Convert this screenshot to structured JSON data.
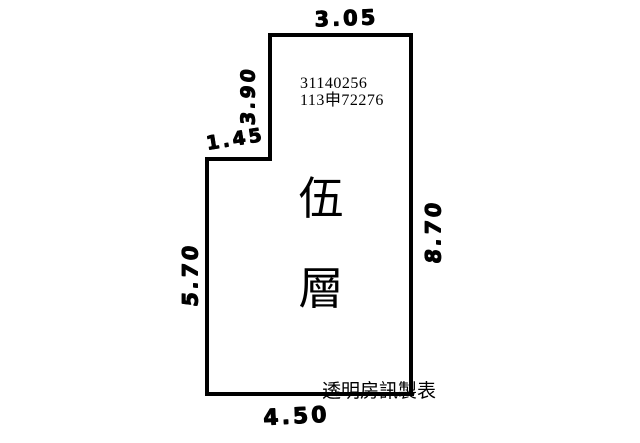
{
  "dimensions": {
    "top": "3.05",
    "upper_left": "3.90",
    "notch": "1.45",
    "left_lower": "5.70",
    "right": "8.70",
    "bottom": "4.50"
  },
  "labels": {
    "parcel_line1": "31140256",
    "parcel_line2": "113申72276",
    "floor_char_1": "伍",
    "floor_char_2": "層",
    "credit": "透明房訊製表"
  },
  "colors": {
    "line": "#000000",
    "ink": "#000000",
    "background": "#ffffff"
  }
}
